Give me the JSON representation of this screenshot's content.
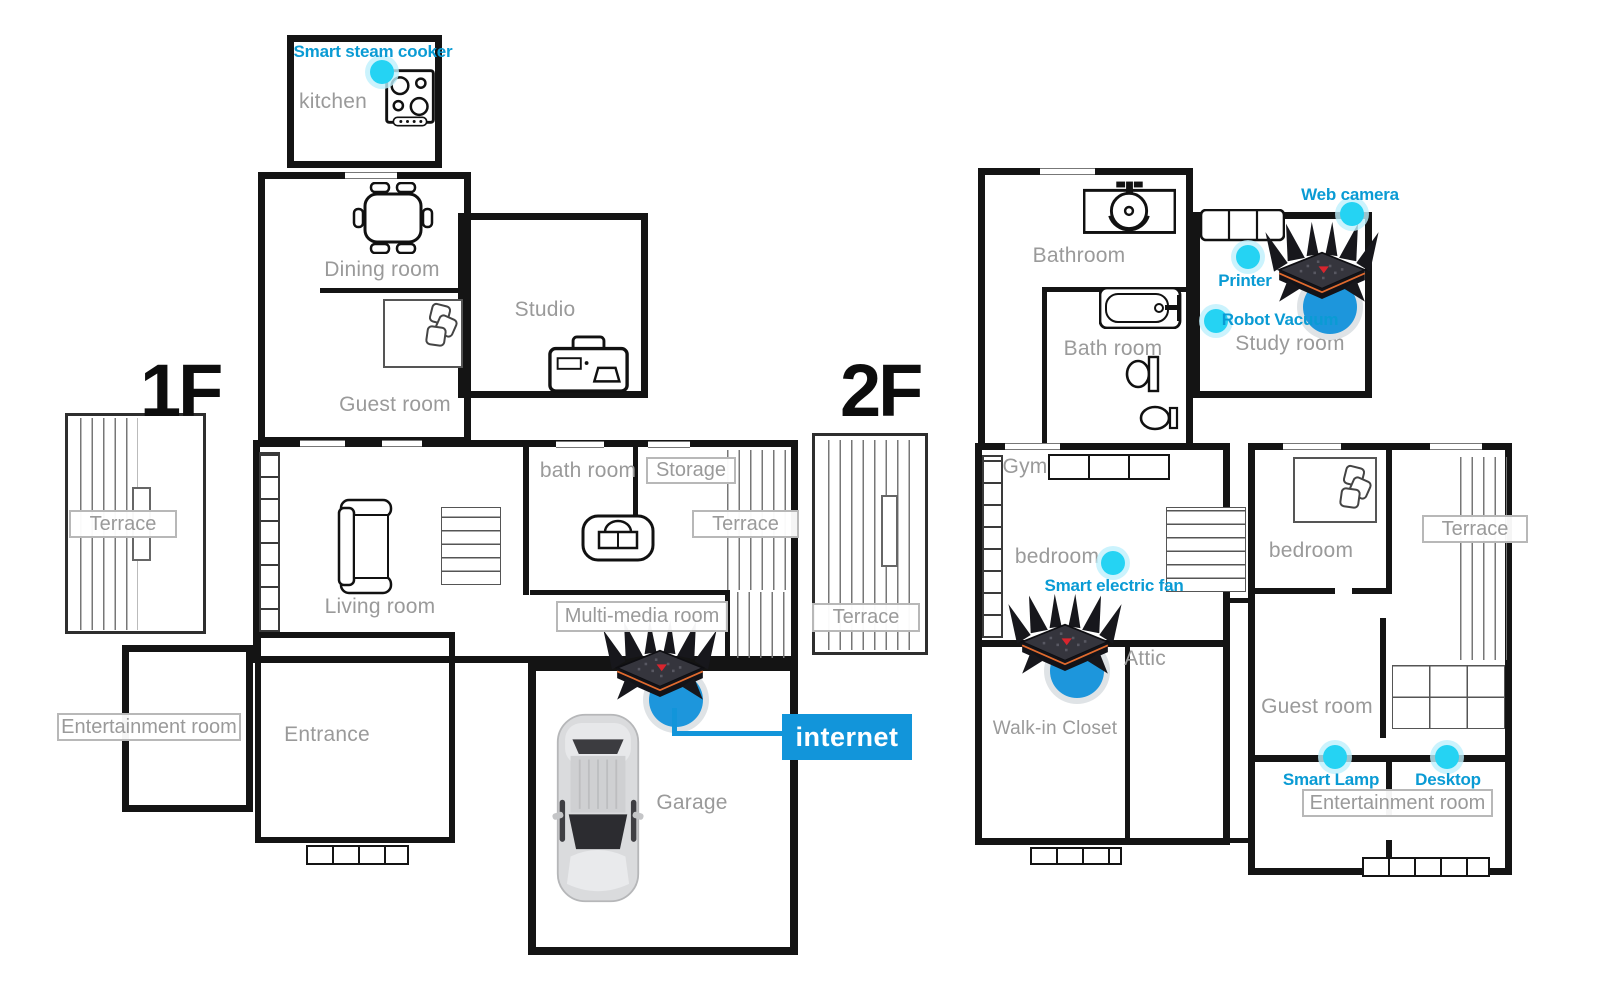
{
  "floors": {
    "floor1": "1F",
    "floor2": "2F"
  },
  "rooms": {
    "kitchen": "kitchen",
    "dining_room": "Dining room",
    "studio": "Studio",
    "guest_room_1f": "Guest room",
    "living_room": "Living room",
    "bath_room_1f": "bath room",
    "entrance": "Entrance",
    "garage": "Garage",
    "bathroom_2f": "Bathroom",
    "bath_room_2f": "Bath room",
    "gym": "Gym",
    "bedroom_2f_left": "bedroom",
    "study_room": "Study room",
    "attic": "Attic",
    "walk_in_closet": "Walk-in Closet",
    "bedroom_2f_right": "bedroom",
    "guest_room_2f": "Guest room"
  },
  "boxed_labels": {
    "terrace_1f_left": "Terrace",
    "storage": "Storage",
    "terrace_1f_right": "Terrace",
    "multi_media_room": "Multi-media room",
    "entertainment_room_1f": "Entertainment room",
    "terrace_2f_left": "Terrace",
    "terrace_2f_right": "Terrace",
    "entertainment_room_2f": "Entertainment room"
  },
  "devices": {
    "smart_steam_cooker": "Smart steam cooker",
    "web_camera": "Web camera",
    "printer": "Printer",
    "robot_vacuum": "Robot Vacuum",
    "smart_electric_fan": "Smart electric fan",
    "smart_lamp": "Smart Lamp",
    "desktop": "Desktop"
  },
  "network": {
    "internet_label": "internet"
  },
  "colors": {
    "wall": "#141414",
    "room_label": "#9a9a9a",
    "device_dot": "#25d3f3",
    "device_label": "#0a9bd4",
    "internet_blue": "#1295da",
    "router_circle": "#1d96dc"
  }
}
